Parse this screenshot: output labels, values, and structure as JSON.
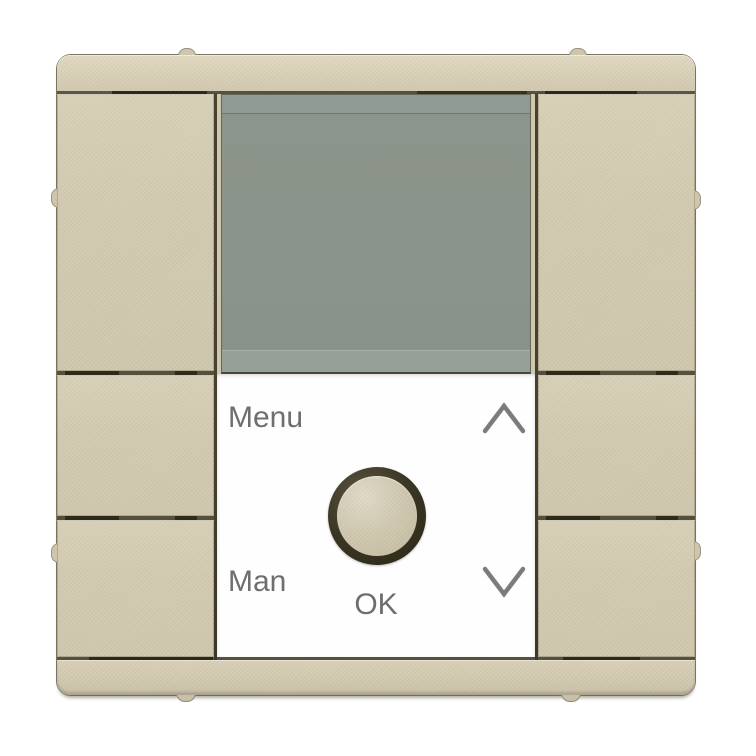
{
  "panel": {
    "menu_label": "Menu",
    "man_label": "Man",
    "ok_label": "OK"
  },
  "icons": {
    "up": "chevron-up-icon",
    "down": "chevron-down-icon"
  },
  "colors": {
    "background": "#ffffff",
    "frame_champagne": "#d5ccb3",
    "key_champagne": "#d3cab1",
    "display_top_strip": "#8f9a94",
    "display_main": "#8b948a",
    "display_bottom_strip": "#96a096",
    "groove_dark": "#3c3827",
    "panel_white": "#fefefe",
    "label_gray": "#6e6e6e",
    "knob_ring": "#362f1e",
    "knob_face": "#cdc5ab",
    "chevron_gray": "#7c7c7c"
  }
}
